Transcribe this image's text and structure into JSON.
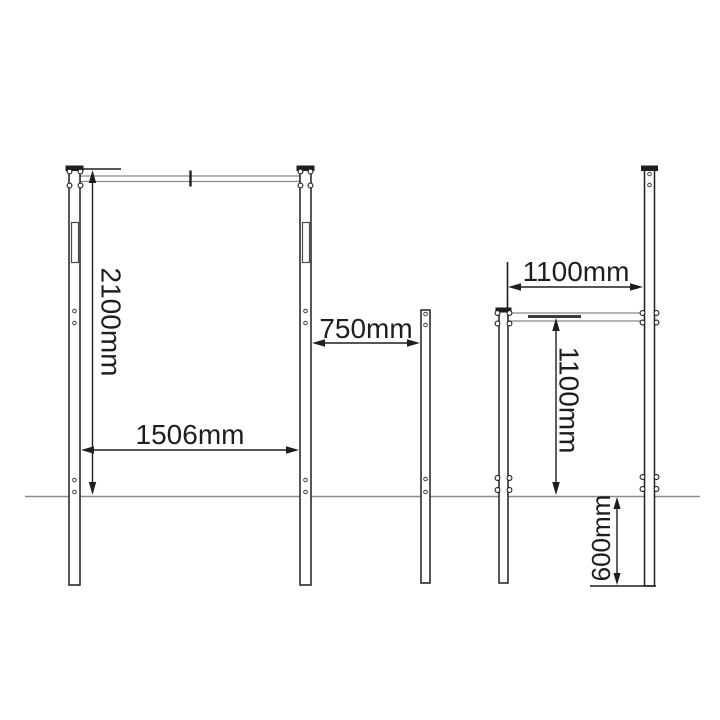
{
  "colors": {
    "ink": "#1e1e1e",
    "steel": "#8c8c8c",
    "background": "#ffffff"
  },
  "diagram": {
    "dimensions": {
      "tall_frame_height": {
        "label": "2100mm",
        "value": 2100,
        "unit": "mm"
      },
      "tall_frame_width": {
        "label": "1506mm",
        "value": 1506,
        "unit": "mm"
      },
      "middle_post_gap": {
        "label": "750mm",
        "value": 750,
        "unit": "mm"
      },
      "low_frame_width": {
        "label": "1100mm",
        "value": 1100,
        "unit": "mm"
      },
      "low_bar_height": {
        "label": "1100mm",
        "value": 1100,
        "unit": "mm"
      },
      "buried_depth": {
        "label": "600mm",
        "value": 600,
        "unit": "mm"
      }
    }
  }
}
